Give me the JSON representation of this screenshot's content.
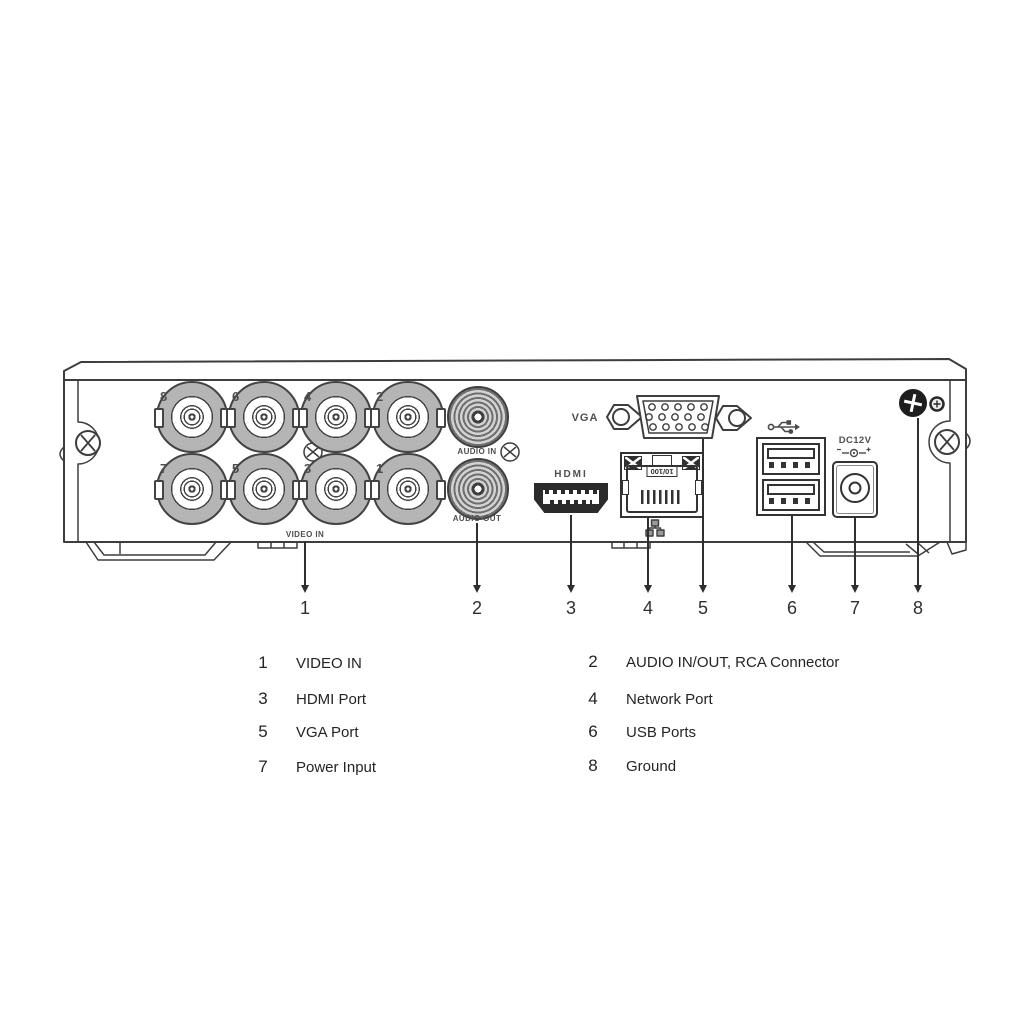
{
  "panel": {
    "video_in": {
      "label": "VIDEO IN",
      "bnc_numbers": [
        "8",
        "6",
        "4",
        "2",
        "7",
        "5",
        "3",
        "1"
      ]
    },
    "audio": {
      "in_label": "AUDIO IN",
      "out_label": "AUDIO OUT"
    },
    "vga": {
      "label": "VGA"
    },
    "hdmi": {
      "logo": "HDMI"
    },
    "network": {
      "port_marking": "10/100"
    },
    "power": {
      "label": "DC12V"
    }
  },
  "callouts": [
    "1",
    "2",
    "3",
    "4",
    "5",
    "6",
    "7",
    "8"
  ],
  "legend": {
    "items": [
      {
        "num": "1",
        "label": "VIDEO IN"
      },
      {
        "num": "2",
        "label": "AUDIO IN/OUT, RCA Connector"
      },
      {
        "num": "3",
        "label": "HDMI Port"
      },
      {
        "num": "4",
        "label": "Network Port"
      },
      {
        "num": "5",
        "label": "VGA Port"
      },
      {
        "num": "6",
        "label": "USB Ports"
      },
      {
        "num": "7",
        "label": "Power Input"
      },
      {
        "num": "8",
        "label": "Ground"
      }
    ]
  },
  "icons": {
    "usb_icon": "usb-trident",
    "network_icon": "ethernet-nodes",
    "power_polarity_icon": "dc-center-positive",
    "ground_screw_icon": "phillips-screw"
  },
  "colors": {
    "line": "#3d3d3d",
    "metal_gray": "#b5b5b5",
    "text": "#2f2f2f",
    "background": "#ffffff"
  }
}
